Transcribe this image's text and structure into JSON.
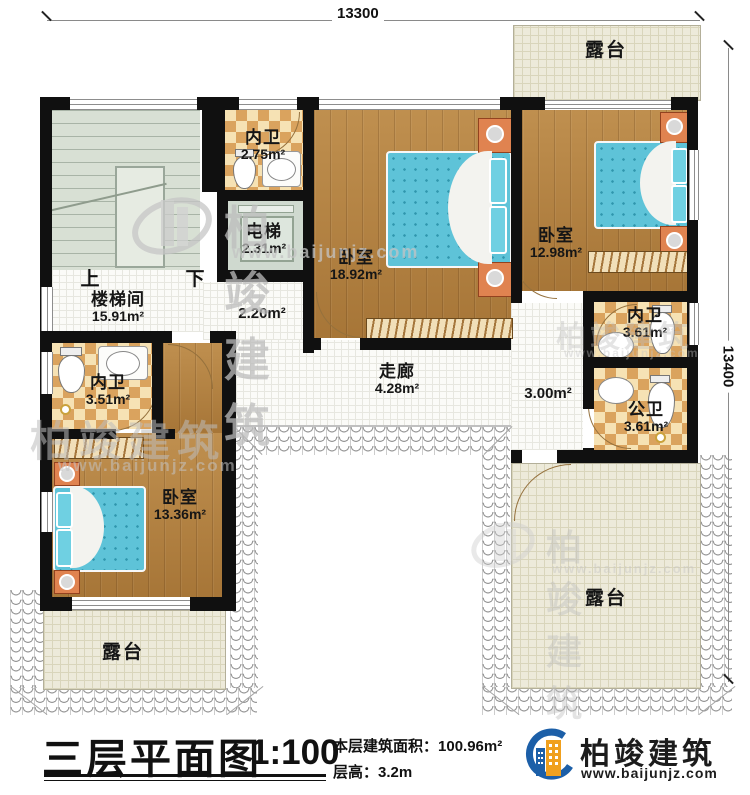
{
  "dimensions": {
    "top": "13300",
    "right": "13400"
  },
  "rooms": {
    "terrace_top_right": {
      "name": "露台"
    },
    "bath_top": {
      "name": "内卫",
      "area": "2.75m²"
    },
    "elevator": {
      "name": "电梯",
      "area": "2.31m²"
    },
    "bedroom_center": {
      "name": "卧室",
      "area": "18.92m²"
    },
    "bedroom_right": {
      "name": "卧室",
      "area": "12.98m²"
    },
    "stairwell": {
      "name": "楼梯间",
      "area": "15.91m²",
      "up": "上",
      "down": "下"
    },
    "hall_upper": {
      "area": "2.20m²"
    },
    "corridor": {
      "name": "走廊",
      "area": "4.28m²"
    },
    "hall_right": {
      "area": "3.00m²"
    },
    "bath_right": {
      "name": "内卫",
      "area": "3.61m²"
    },
    "bath_public": {
      "name": "公卫",
      "area": "3.61m²"
    },
    "bath_left": {
      "name": "内卫",
      "area": "3.51m²"
    },
    "bedroom_bottom": {
      "name": "卧室",
      "area": "13.36m²"
    },
    "terrace_bottom_left": {
      "name": "露台"
    },
    "terrace_bottom_right": {
      "name": "露台"
    }
  },
  "title_block": {
    "title": "三层平面图",
    "scale": "1:100",
    "floor_area_label": "本层建筑面积：",
    "floor_area_value": "100.96m²",
    "floor_height_label": "层高：",
    "floor_height_value": "3.2m",
    "brand_name": "柏竣建筑",
    "brand_url": "www.baijunjz.com"
  },
  "watermark": {
    "brand": "柏竣建筑",
    "url": "www.baijunjz.com"
  }
}
